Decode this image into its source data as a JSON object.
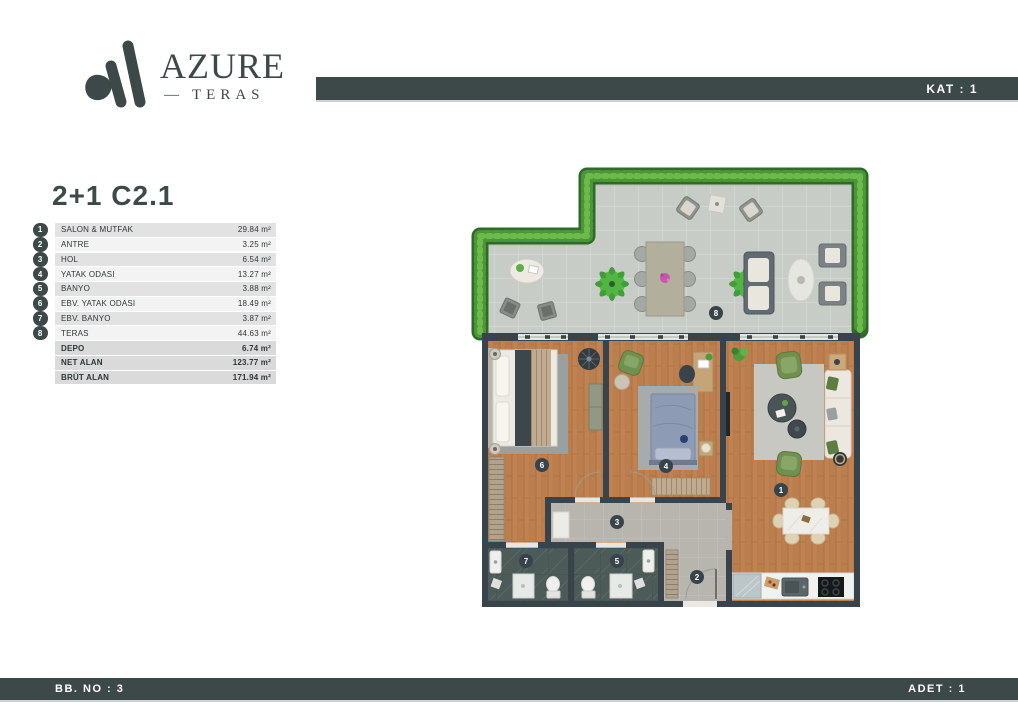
{
  "brand": {
    "name": "AZURE",
    "dash": "—",
    "subtitle": "TERAS"
  },
  "header": {
    "floor_label": "KAT : 1"
  },
  "plan": {
    "code": "2+1 C2.1"
  },
  "table": {
    "rooms": [
      {
        "no": "1",
        "label": "SALON & MUTFAK",
        "area": "29.84 m²"
      },
      {
        "no": "2",
        "label": "ANTRE",
        "area": "3.25 m²"
      },
      {
        "no": "3",
        "label": "HOL",
        "area": "6.54 m²"
      },
      {
        "no": "4",
        "label": "YATAK ODASI",
        "area": "13.27 m²"
      },
      {
        "no": "5",
        "label": "BANYO",
        "area": "3.88 m²"
      },
      {
        "no": "6",
        "label": "EBV. YATAK ODASI",
        "area": "18.49 m²"
      },
      {
        "no": "7",
        "label": "EBV. BANYO",
        "area": "3.87 m²"
      },
      {
        "no": "8",
        "label": "TERAS",
        "area": "44.63 m²"
      }
    ],
    "totals": [
      {
        "label": "DEPO",
        "area": "6.74 m²"
      },
      {
        "label": "NET ALAN",
        "area": "123.77 m²"
      },
      {
        "label": "BRÜT ALAN",
        "area": "171.94 m²"
      }
    ]
  },
  "floorplan": {
    "badges": {
      "b1": "1",
      "b2": "2",
      "b3": "3",
      "b4": "4",
      "b5": "5",
      "b6": "6",
      "b7": "7",
      "b8": "8"
    }
  },
  "footer": {
    "left": "BB. NO : 3",
    "right": "ADET : 1"
  },
  "colors": {
    "slate": "#3d4848",
    "wall": "#39434b",
    "wood": "#c08252",
    "terrace_tile": "#c7ccc6",
    "hedge": "#4c9639",
    "accent_green": "#70904f"
  }
}
